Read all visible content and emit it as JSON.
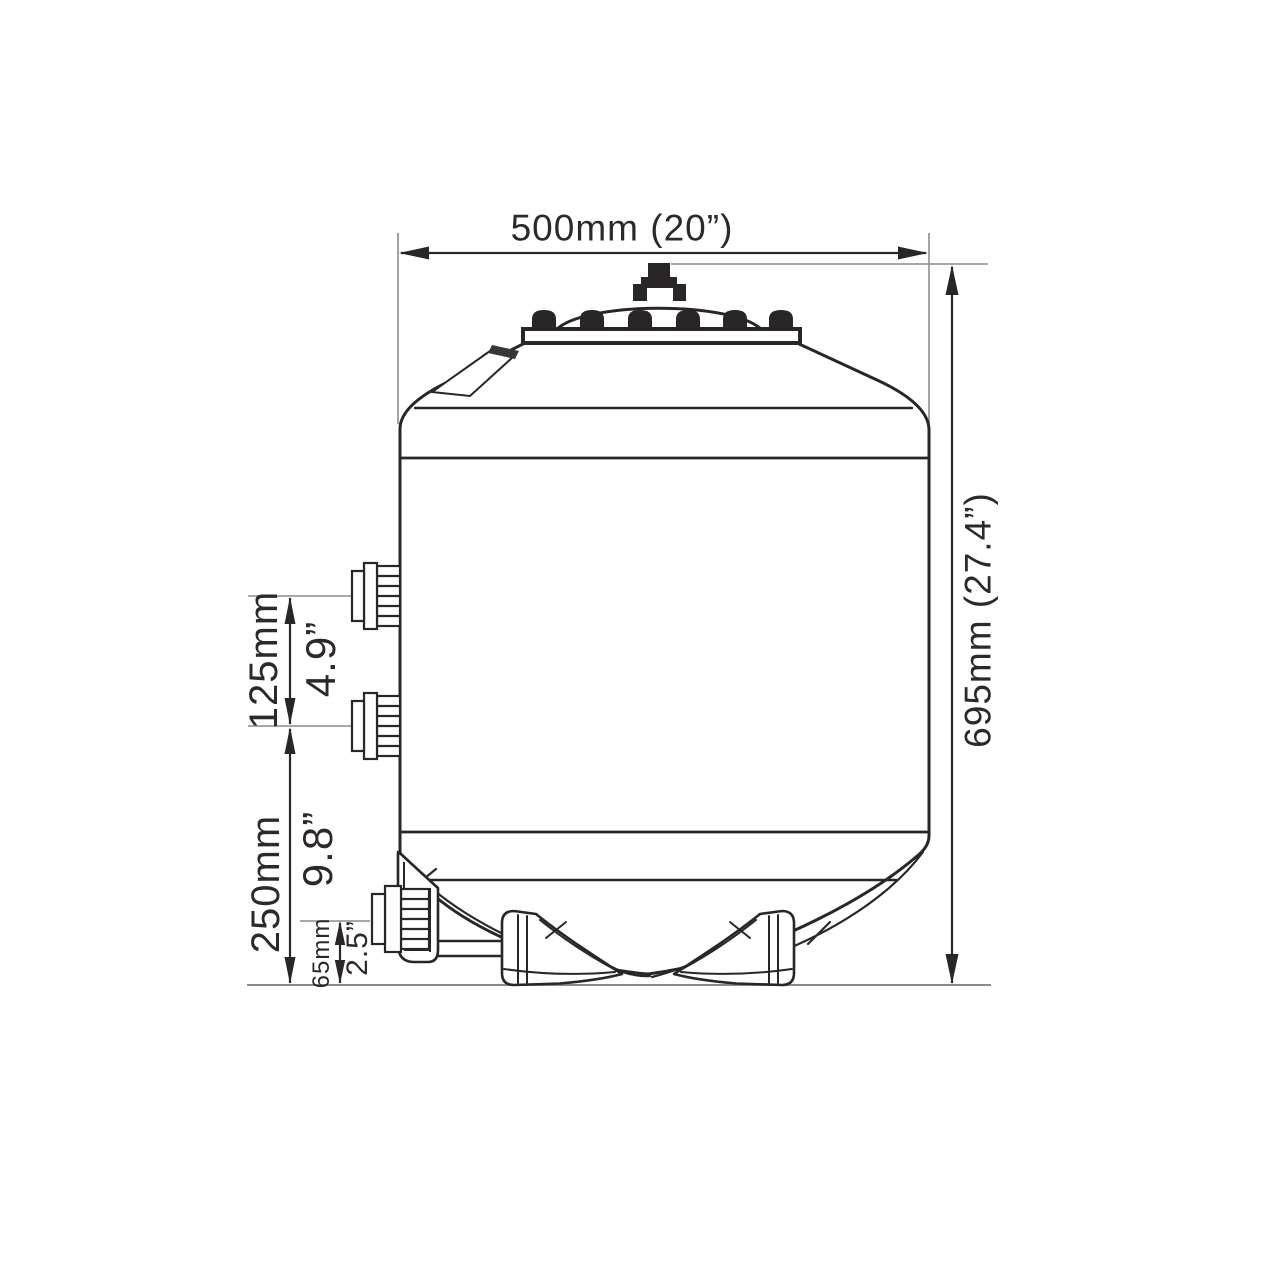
{
  "diagram": {
    "type": "technical_line_drawing",
    "subject": "filter tank side elevation with dimension annotations",
    "background": "#ffffff",
    "line_color": "#2a2627",
    "extension_line_color": "#8c8c8c",
    "text_color": "#2d292a",
    "dims": {
      "width": "500mm (20”)",
      "height": "695mm (27.4”)",
      "port_spacing_mm": "125mm",
      "port_spacing_in": "4.9”",
      "lower_mm": "250mm",
      "lower_in": "9.8”",
      "drain_mm": "65mm",
      "drain_in": "2.5”"
    }
  }
}
